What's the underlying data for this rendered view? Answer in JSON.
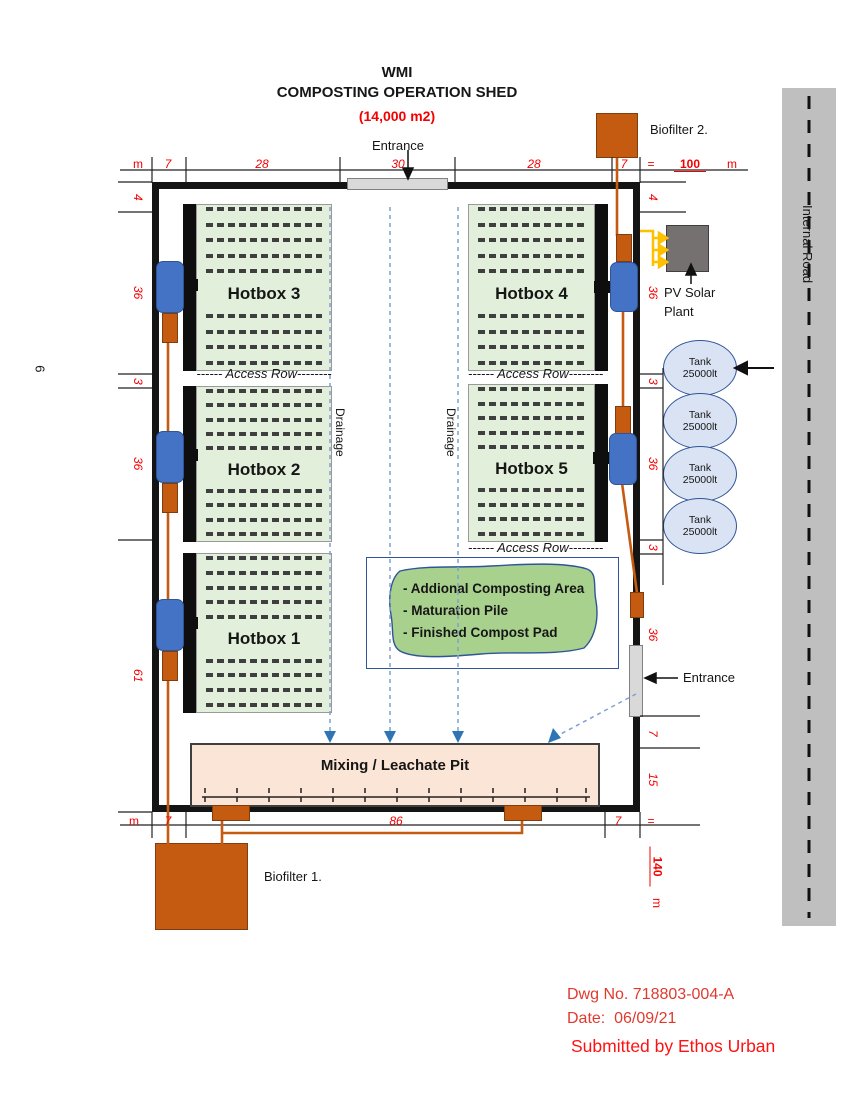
{
  "page": {
    "number": "9"
  },
  "title": {
    "line1": "WMI",
    "line2": "COMPOSTING OPERATION SHED",
    "area": "(14,000 m2)"
  },
  "shed": {
    "entrance_top": "Entrance",
    "entrance_right": "Entrance",
    "hotboxes": [
      {
        "label": "Hotbox 3"
      },
      {
        "label": "Hotbox 2"
      },
      {
        "label": "Hotbox 1"
      },
      {
        "label": "Hotbox 4"
      },
      {
        "label": "Hotbox 5"
      }
    ],
    "access_row": "------ Access Row--------",
    "drainage": "Drainage",
    "pit_label": "Mixing / Leachate Pit",
    "composting_area": {
      "line1": "- Addional Composting Area",
      "line2": "- Maturation Pile",
      "line3": "- Finished Compost Pad"
    }
  },
  "equipment": {
    "biofilter1": "Biofilter 1.",
    "biofilter2": "Biofilter 2.",
    "pv_label": "PV Solar Plant",
    "tanks": [
      {
        "name": "Tank",
        "capacity": "25000lt"
      },
      {
        "name": "Tank",
        "capacity": "25000lt"
      },
      {
        "name": "Tank",
        "capacity": "25000lt"
      },
      {
        "name": "Tank",
        "capacity": "25000lt"
      }
    ]
  },
  "road": {
    "label": "Internal Road"
  },
  "dims": {
    "top": [
      "m",
      "7",
      "28",
      "30",
      "28",
      "7",
      "=",
      "100",
      "m"
    ],
    "bottom": [
      "m",
      "7",
      "86",
      "7",
      "=",
      "140",
      "m"
    ],
    "left": [
      "4",
      "36",
      "3",
      "36",
      "61"
    ],
    "right": [
      "4",
      "36",
      "3",
      "36",
      "3",
      "36",
      "7",
      "15"
    ]
  },
  "titleblock": {
    "dwg_no": "Dwg No. 718803-004-A",
    "date": "Date:  06/09/21",
    "submitted": "Submitted by Ethos Urban"
  },
  "colors": {
    "accent_orange": "#C55A11",
    "fan_blue": "#4472C4",
    "hotbox_green": "#E2EFDA",
    "maturation_green": "#A9D18E",
    "pit_peach": "#FBE5D6",
    "tank_blue": "#DAE3F3",
    "dim_red": "#F40000",
    "road_gray": "#BFBFBF",
    "pv_gray": "#767171",
    "solar_yellow": "#FFC000"
  }
}
